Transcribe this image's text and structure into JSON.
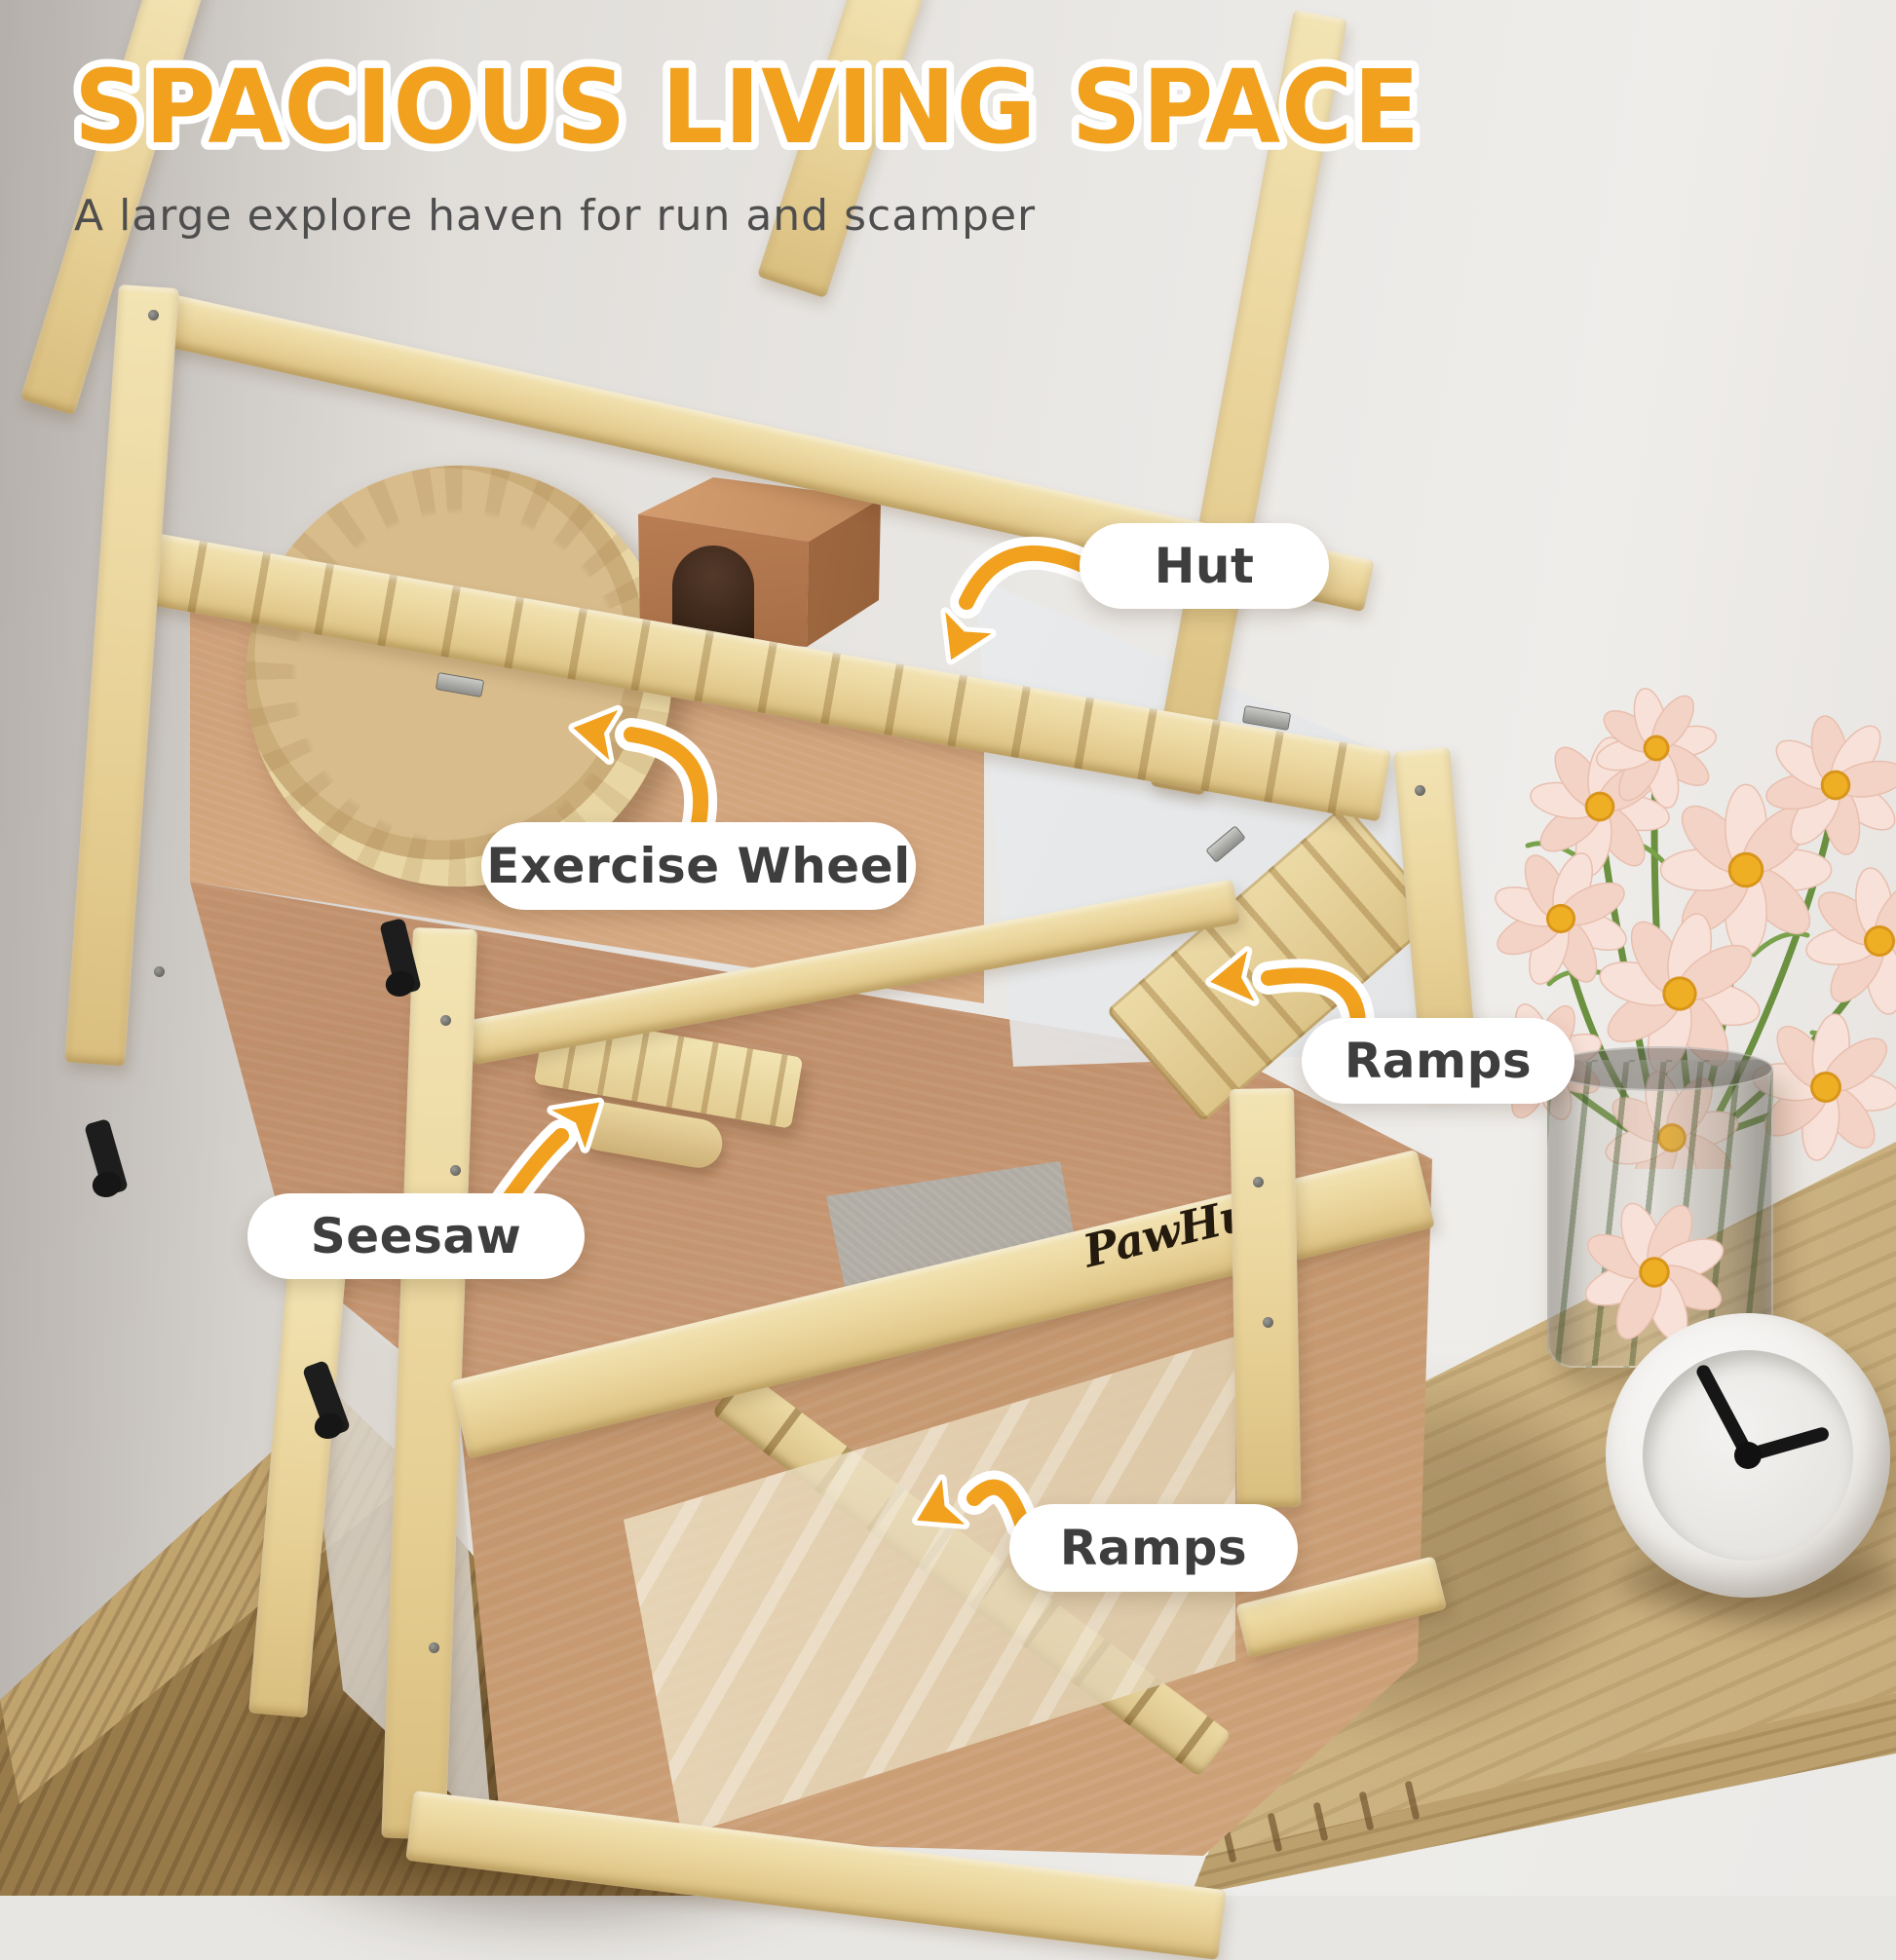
{
  "header": {
    "title": "SPACIOUS LIVING SPACE",
    "subtitle": "A large explore haven for run and scamper"
  },
  "callouts": [
    {
      "id": "hut",
      "label": "Hut"
    },
    {
      "id": "exercise-wheel",
      "label": "Exercise Wheel"
    },
    {
      "id": "ramps-upper",
      "label": "Ramps"
    },
    {
      "id": "seesaw",
      "label": "Seesaw"
    },
    {
      "id": "ramps-lower",
      "label": "Ramps"
    }
  ],
  "brand": {
    "name": "PawHut",
    "logo_icon": "paw-print-icon"
  },
  "style": {
    "accent_orange": "#F1A11E",
    "title_color": "#F1A11E",
    "subtitle_color": "#4E4E4E",
    "label_text_color": "#3E3E3E",
    "pill_background": "#FFFFFF",
    "wood_pine": "#EDDCA8",
    "wood_interior": "#CE9F7B",
    "wall_color": "#E8E6E3"
  },
  "scene": {
    "product": "3-tier wooden hamster cage with open lid",
    "objects": [
      "hamster-cage",
      "exercise-wheel",
      "hut",
      "seesaw",
      "upper-ramp",
      "lower-ramp",
      "flower-vase",
      "alarm-clock",
      "sideboard",
      "cabinet"
    ],
    "clock_time_approx": "2:50"
  }
}
